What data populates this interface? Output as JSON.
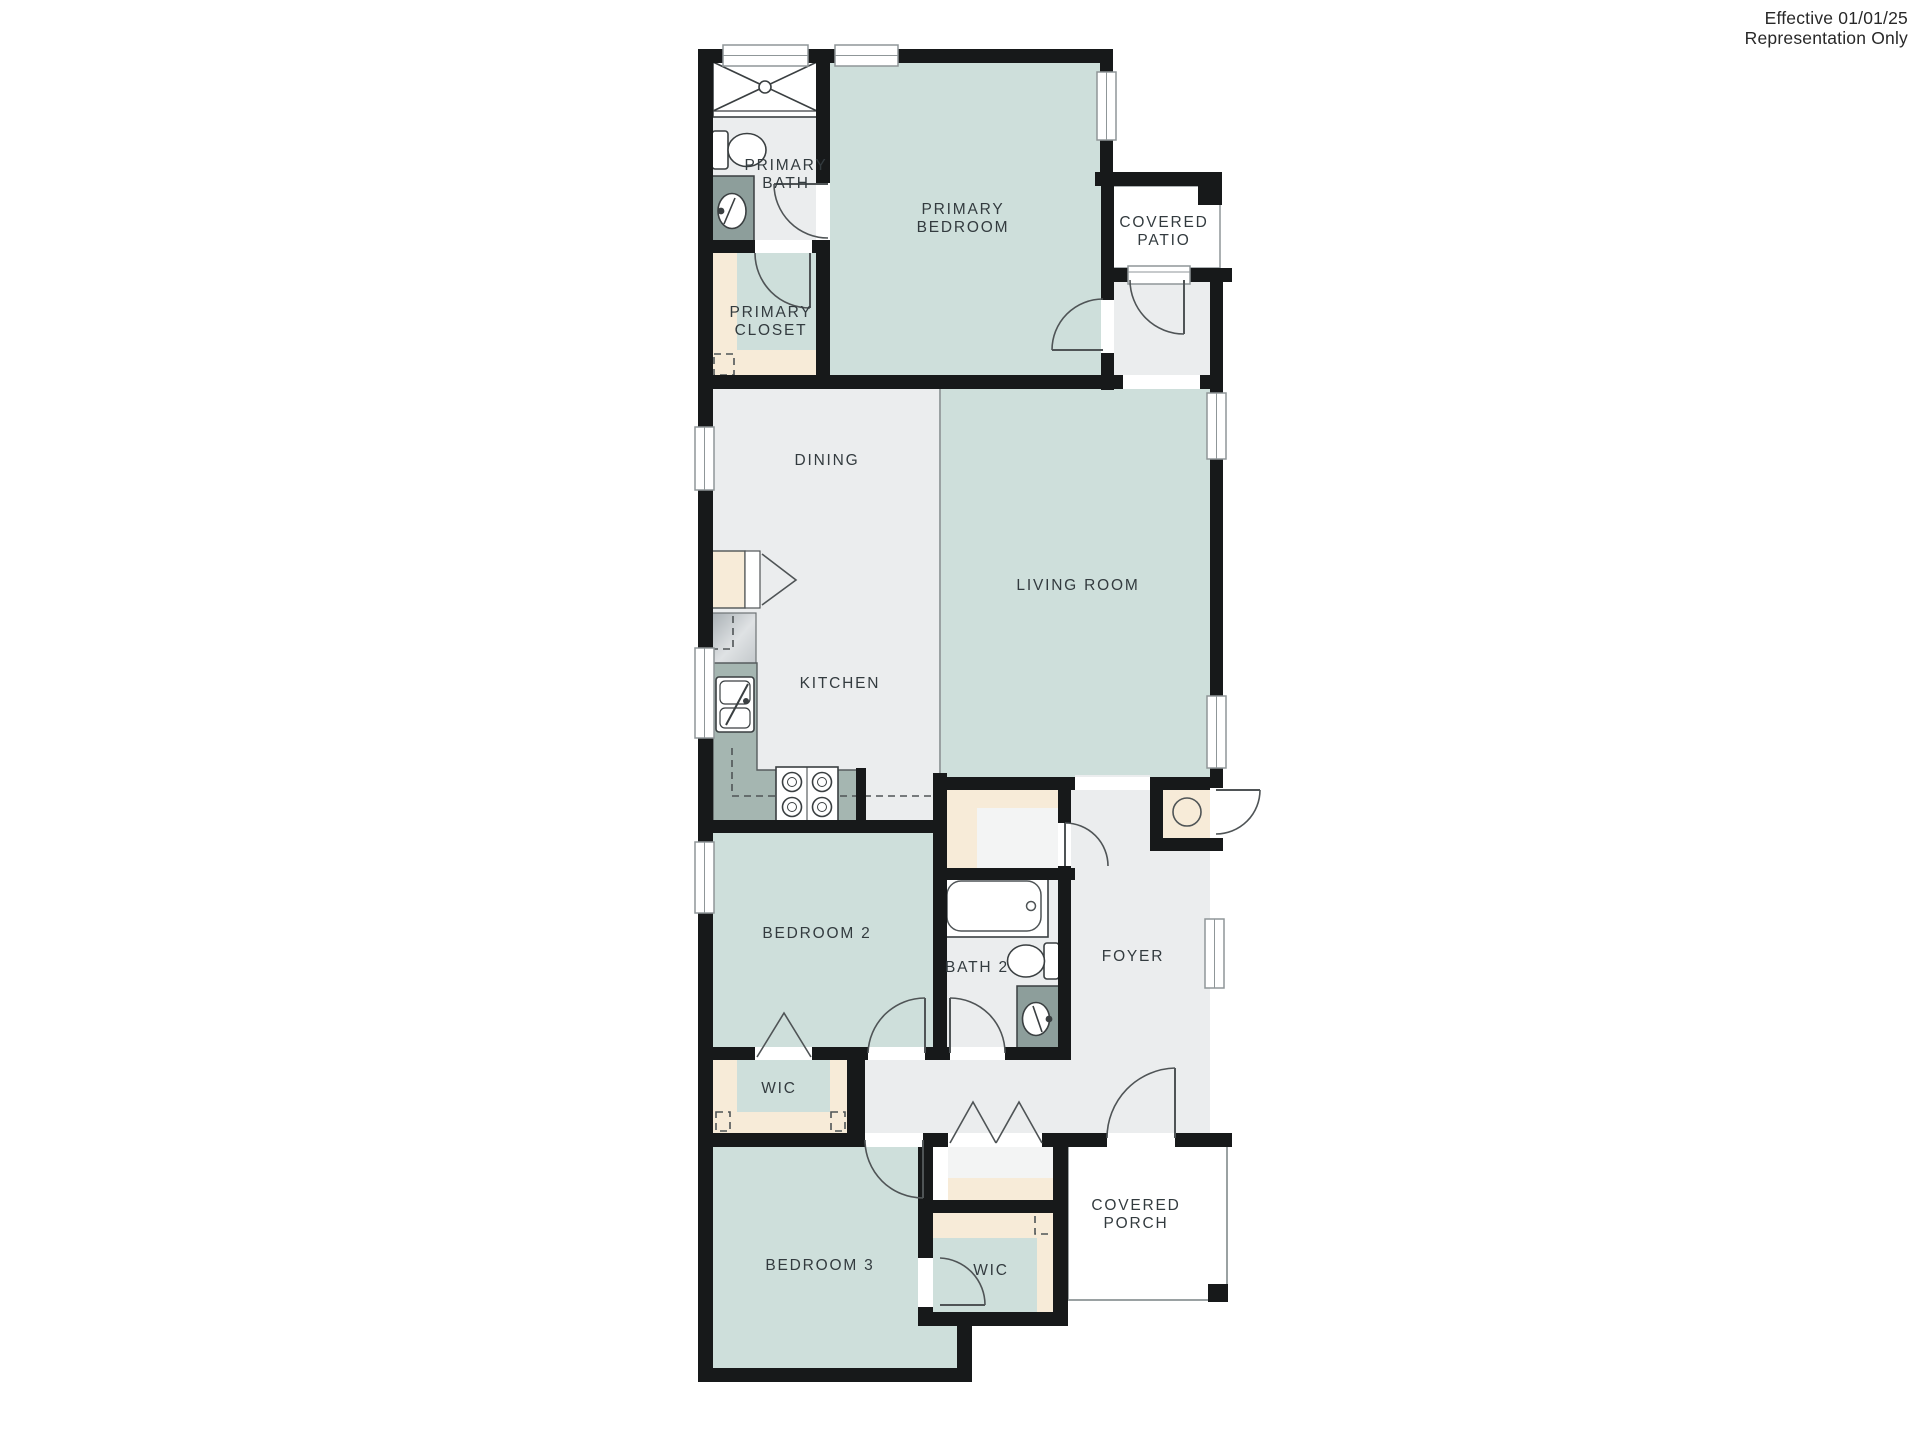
{
  "annotation": {
    "line1": "Effective 01/01/25",
    "line2": "Representation Only"
  },
  "rooms": {
    "primary_bath": {
      "line1": "PRIMARY",
      "line2": "BATH"
    },
    "primary_closet": {
      "line1": "PRIMARY",
      "line2": "CLOSET"
    },
    "primary_bedroom": {
      "line1": "PRIMARY",
      "line2": "BEDROOM"
    },
    "covered_patio": {
      "line1": "COVERED",
      "line2": "PATIO"
    },
    "dining": {
      "label": "DINING"
    },
    "living_room": {
      "label": "LIVING ROOM"
    },
    "kitchen": {
      "label": "KITCHEN"
    },
    "bedroom_2": {
      "label": "BEDROOM 2"
    },
    "bath_2": {
      "label": "BATH 2"
    },
    "foyer": {
      "label": "FOYER"
    },
    "wic_bedroom_2": {
      "label": "WIC"
    },
    "bedroom_3": {
      "label": "BEDROOM 3"
    },
    "wic_bedroom_3": {
      "label": "WIC"
    },
    "covered_porch": {
      "line1": "COVERED",
      "line2": "PORCH"
    }
  },
  "fixtures": [
    "shower",
    "toilet",
    "vanity-sink",
    "bathtub",
    "kitchen-sink",
    "stove-cooktop",
    "refrigerator",
    "pantry",
    "water-heater",
    "closet-shelving"
  ],
  "colors": {
    "room_teal": "#cedfdb",
    "room_gray": "#ebedee",
    "closet_tan": "#f7ebd8",
    "wall_black": "#17191a",
    "counter_green": "#a5b6b1",
    "vanity_gray": "#8d9e9b",
    "label_text": "#333b3f"
  }
}
